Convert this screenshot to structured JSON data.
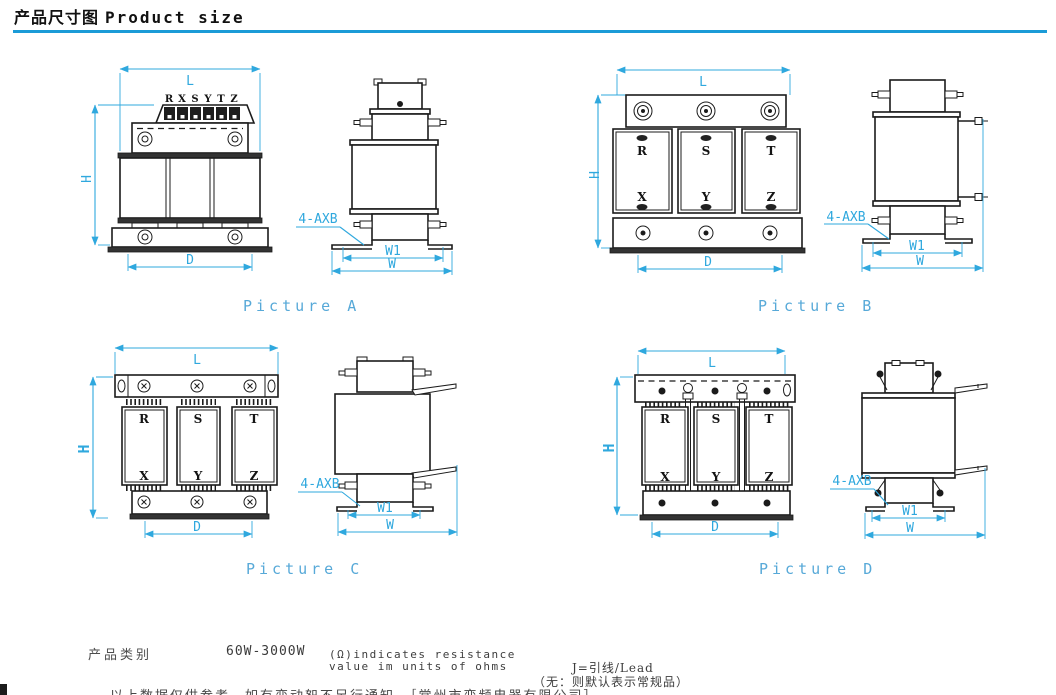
{
  "header": {
    "title_zh": "产品尺寸图",
    "title_en": "Product size",
    "accent_color": "#1b9bd7"
  },
  "dims": {
    "l": "L",
    "h": "H",
    "d": "D",
    "w": "W",
    "w1": "W1",
    "axb": "4-AXB"
  },
  "terminal_row": [
    "R",
    "X",
    "S",
    "Y",
    "T",
    "Z"
  ],
  "phases_top": [
    "R",
    "S",
    "T"
  ],
  "phases_bottom": [
    "X",
    "Y",
    "Z"
  ],
  "captions": {
    "a": "Picture A",
    "b": "Picture B",
    "c": "Picture C",
    "d": "Picture D"
  },
  "footer": {
    "category_label": "产品类别",
    "power_range": "60W-3000W",
    "resistance_note": "(Ω)indicates resistance\nvalue im units of ohms",
    "lead_note": "J=引线/Lead",
    "default_note": "（无：则默认表示常规品）",
    "truncated_note": "以上数据仅供参考，如有变动恕不另行通知。［常州市变频电器有限公司］"
  },
  "colors": {
    "dimension": "#2fa8de",
    "caption": "#57a9d8",
    "line": "#1b1b1b"
  }
}
